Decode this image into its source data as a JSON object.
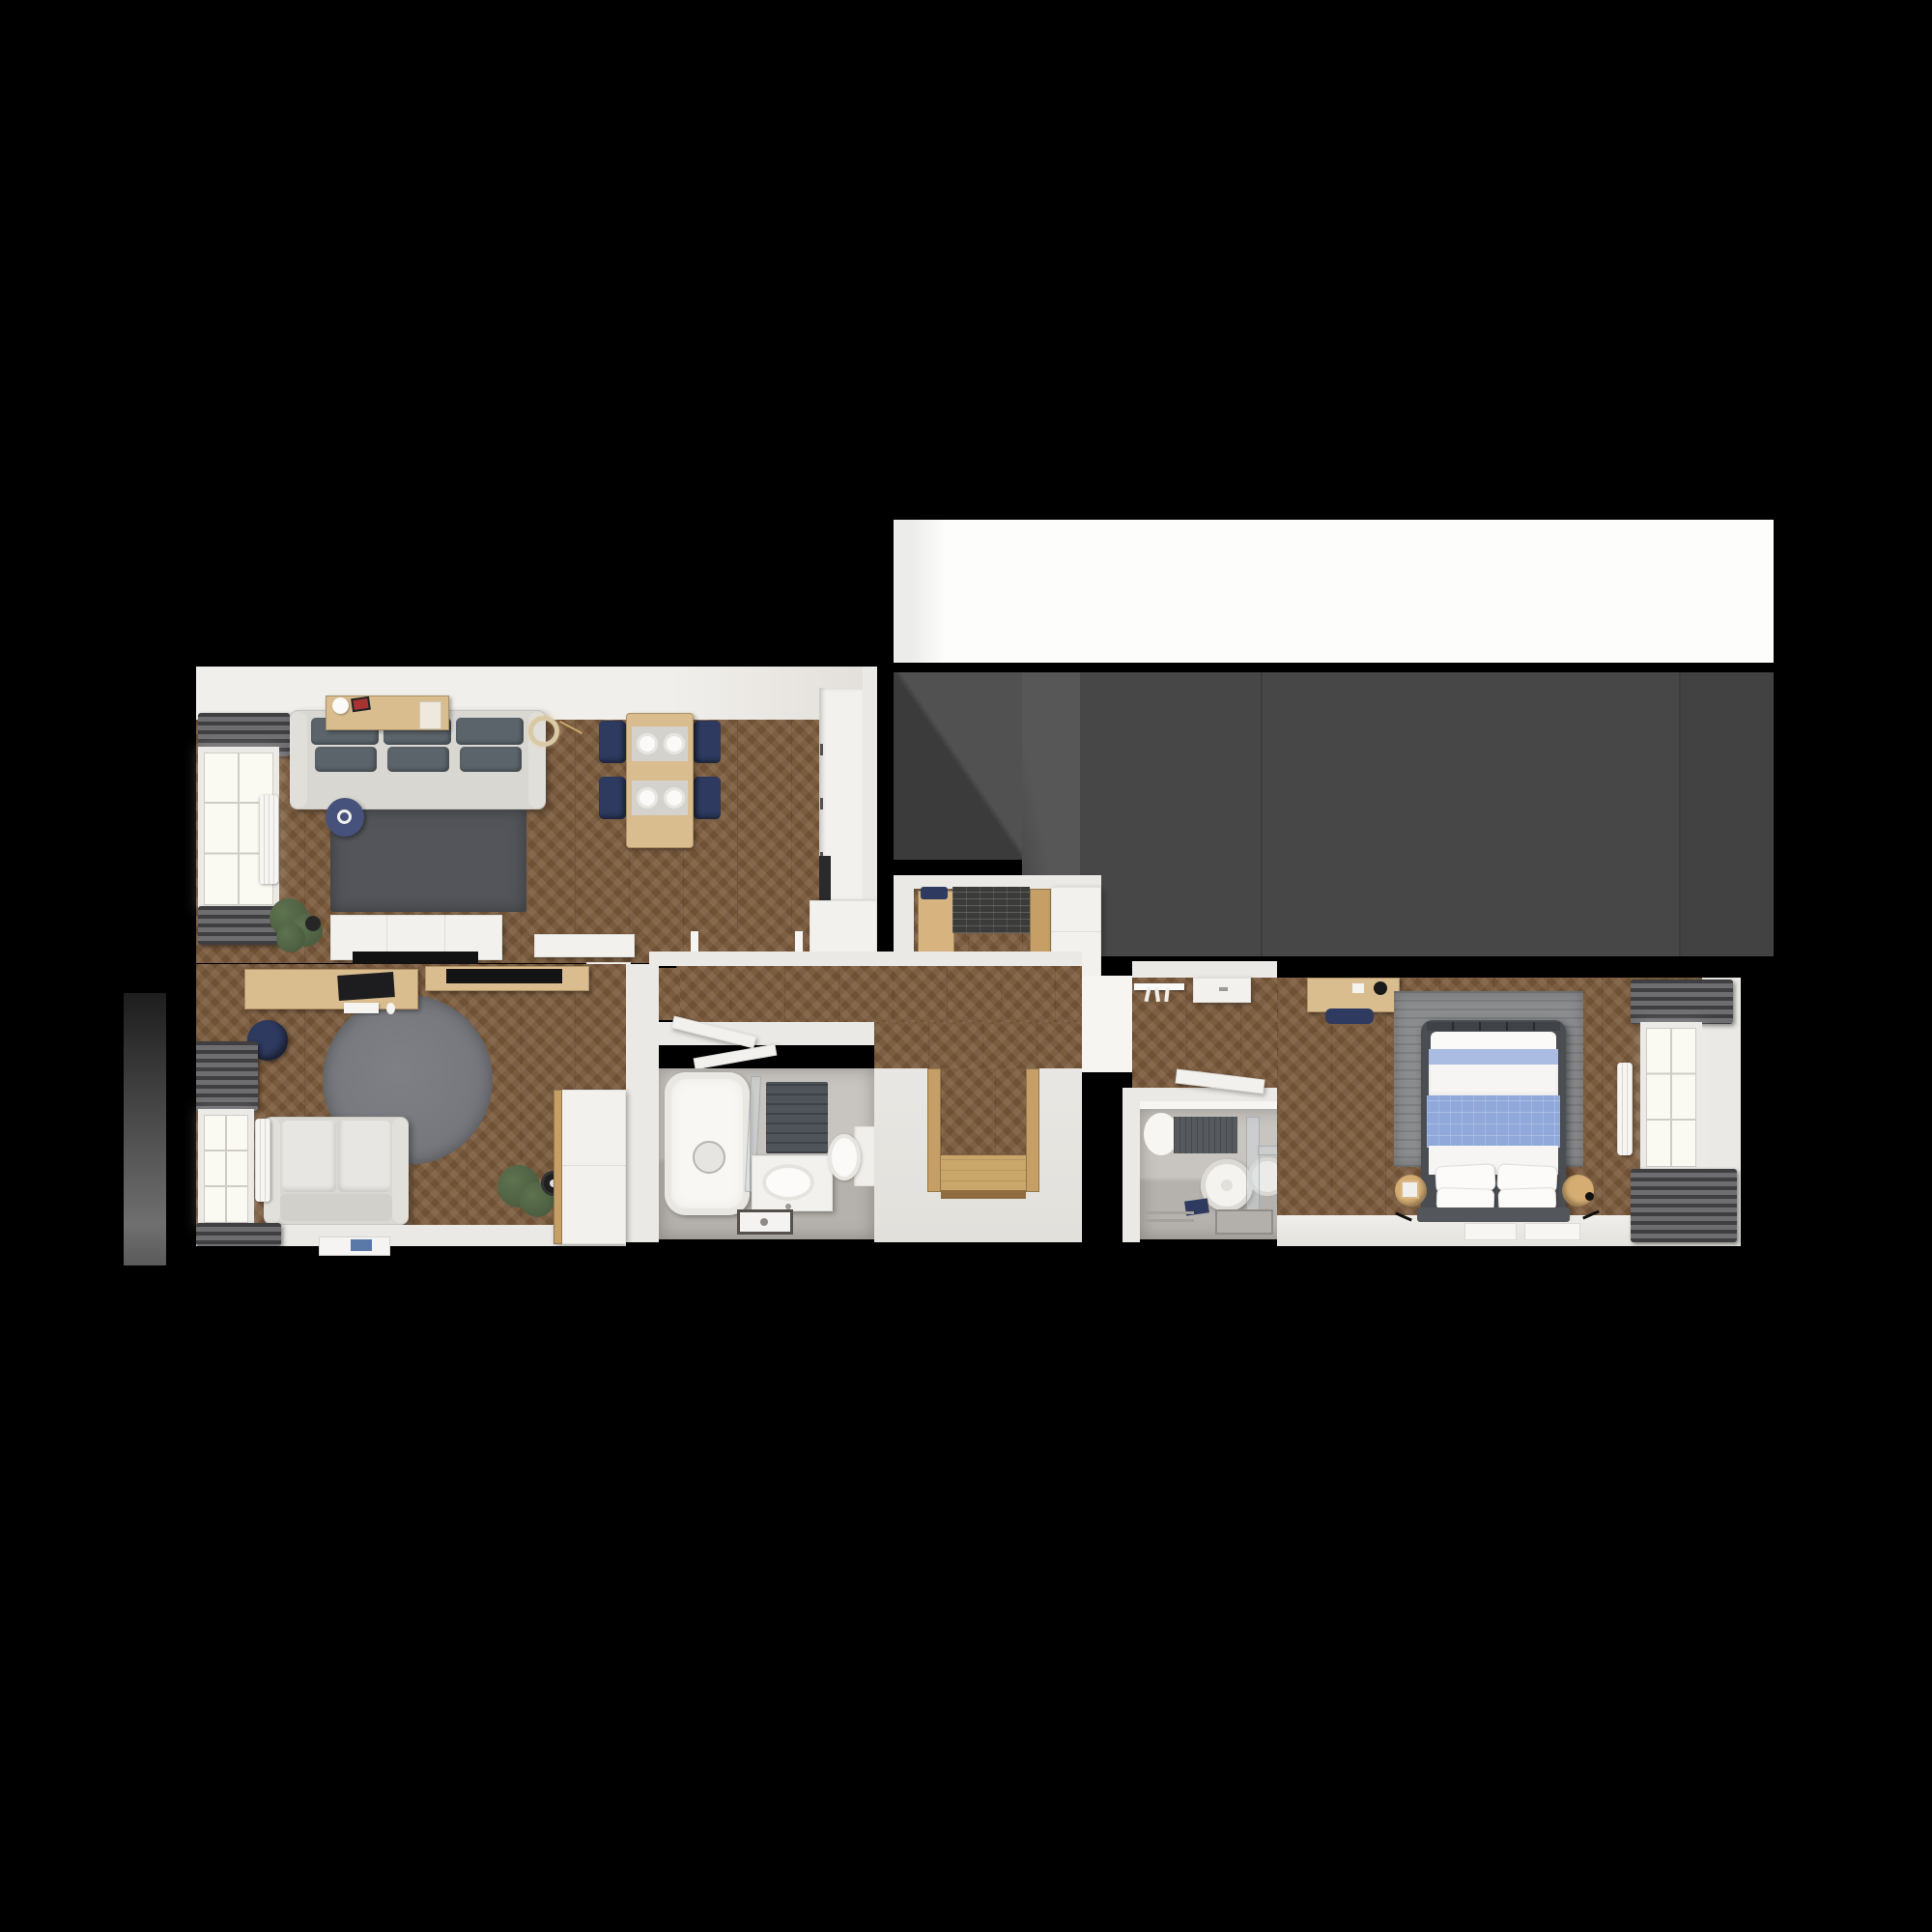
{
  "title": "Top-down 3D floor plan render of a one-bedroom apartment on black background",
  "palette": {
    "bg": "#000000",
    "terraceWhite": "#fdfdfc",
    "roofGray": "#474747",
    "roofGrayDark": "#3b3b3b",
    "roofGrayLight": "#545454",
    "wall": "#ebe9e5",
    "wallBright": "#f6f5f2",
    "whiteFurn": "#f2f1ee",
    "wood": "#7b5a3b",
    "nicheWood": "#c59f66",
    "nicheFloor": "#c9a76b",
    "deskWood": "#dabd8e",
    "tile": "#c8c4bf",
    "tileFloor": "#b5b1ac",
    "glow": "#fbfaf2",
    "curtainDark": "#3f3f41",
    "curtainLight": "#6e6e71",
    "sofa": "#d9d7d2",
    "cushion": "#5b646b",
    "rugDark": "#53555a",
    "rugRound": "#76787d",
    "rugBed": "#8a8c8e",
    "navy": "#2e3a5f",
    "navyTable": "#46527c",
    "blueBlanket": "#91a9da",
    "blueFold": "#aabce2",
    "bedFrame": "#4a4d52",
    "plant": "#4c5e40",
    "gold": "#d9c9a4",
    "red": "#a83333",
    "dark": "#141414"
  },
  "rooms": [
    {
      "id": "living-room",
      "label": "living-dining-room-with-kitchen"
    },
    {
      "id": "office",
      "label": "home-office-second-room"
    },
    {
      "id": "bathroom-main",
      "label": "main-bathroom-with-tub"
    },
    {
      "id": "hallway",
      "label": "hallway-and-entry-vestibule"
    },
    {
      "id": "bathroom-ensuite",
      "label": "shower-bathroom"
    },
    {
      "id": "bedroom",
      "label": "bedroom"
    },
    {
      "id": "roof",
      "label": "adjacent-roof-terrace-area"
    }
  ],
  "furniture": [
    "three-seat-sofa",
    "console-shelf",
    "pendant-lamp",
    "dark-rug",
    "blue-side-table",
    "tv-sideboard",
    "tv",
    "dining-table",
    "dining-chairs",
    "plates",
    "kitchen-counter",
    "oven",
    "entry-bench",
    "shoe-mat",
    "hall-cabinet",
    "coat-rail",
    "entry-door-niche",
    "desk",
    "monitor",
    "office-chair",
    "round-rug",
    "loveseat-sofa",
    "plant",
    "wardrobe",
    "bathtub",
    "shower-screen",
    "washbasin",
    "toilet",
    "towel",
    "floor-drain",
    "round-mirror",
    "double-bed",
    "blue-blanket",
    "pillows",
    "bedside-cylinder-tables",
    "bedroom-desk",
    "bedroom-rug",
    "door-leaf",
    "radiator",
    "window",
    "curtains"
  ]
}
